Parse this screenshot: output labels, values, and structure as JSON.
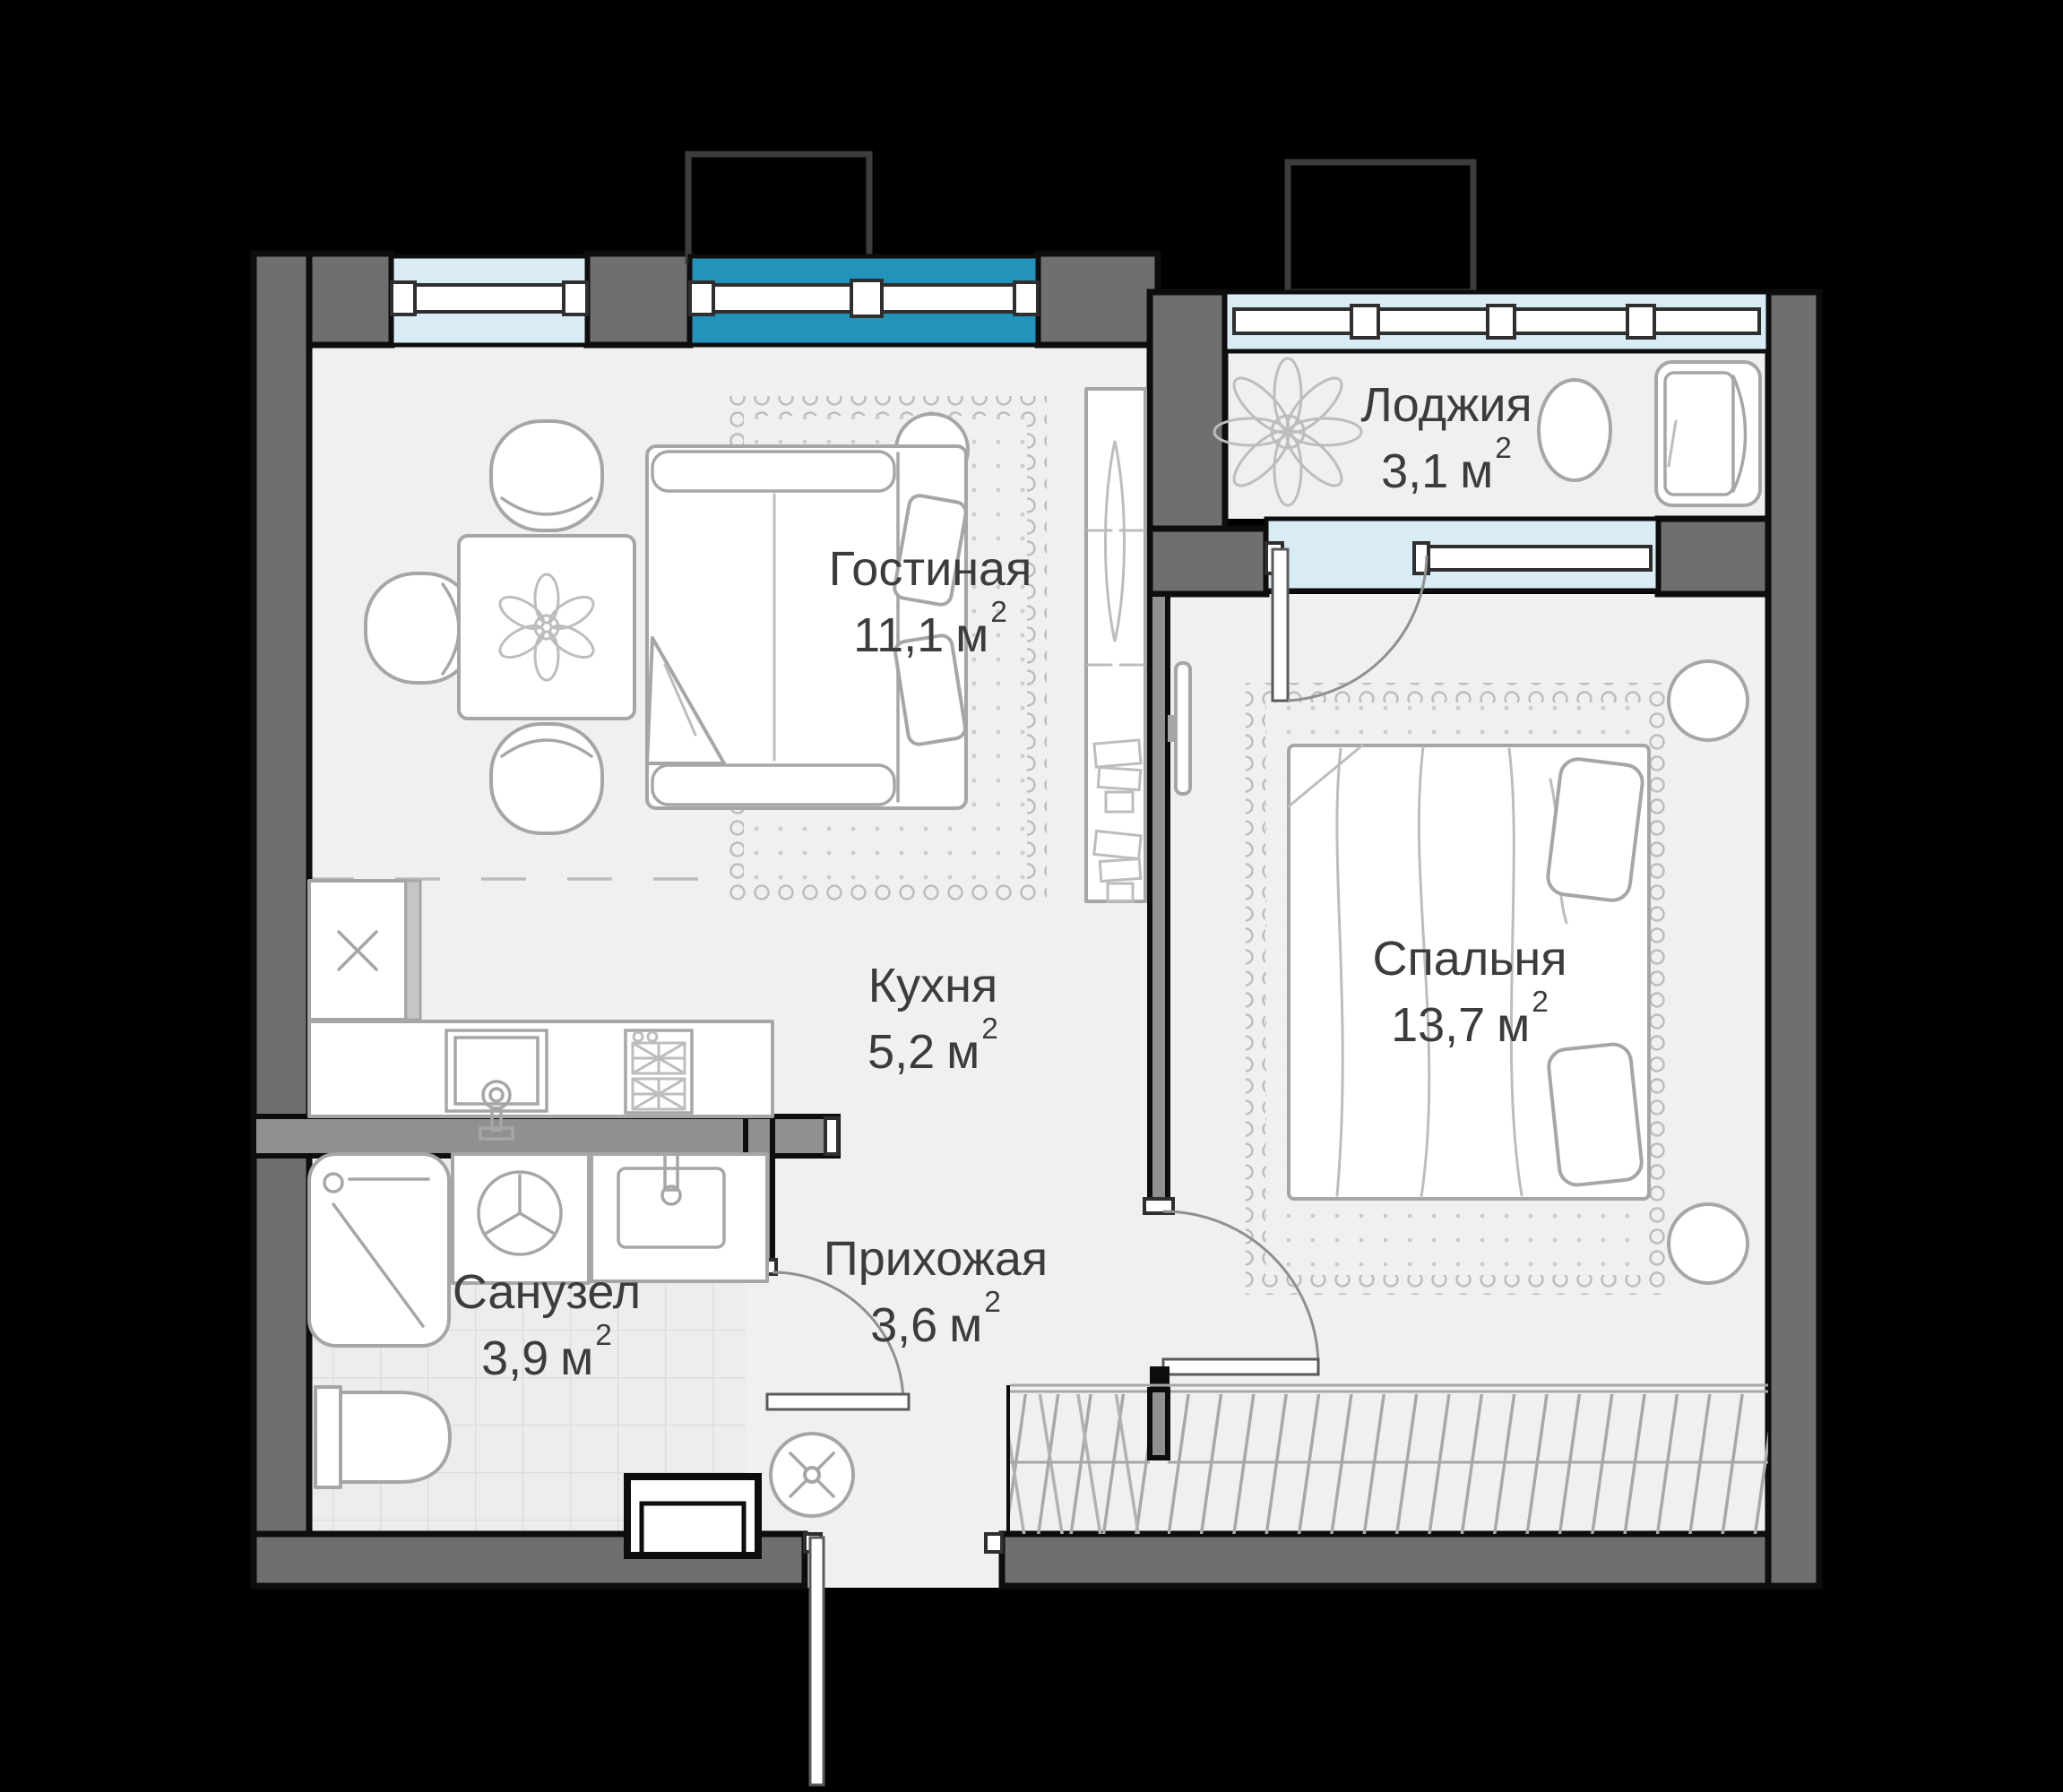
{
  "plan_title": "",
  "rooms": [
    {
      "id": "living-room",
      "name": "Гостиная",
      "area": "11,1",
      "unit": "м",
      "sup": "2"
    },
    {
      "id": "loggia",
      "name": "Лоджия",
      "area": "3,1",
      "unit": "м",
      "sup": "2"
    },
    {
      "id": "kitchen",
      "name": "Кухня",
      "area": "5,2",
      "unit": "м",
      "sup": "2"
    },
    {
      "id": "bedroom",
      "name": "Спальня",
      "area": "13,7",
      "unit": "м",
      "sup": "2"
    },
    {
      "id": "bathroom",
      "name": "Санузел",
      "area": "3,9",
      "unit": "м",
      "sup": "2"
    },
    {
      "id": "hallway",
      "name": "Прихожая",
      "area": "3,6",
      "unit": "м",
      "sup": "2"
    }
  ],
  "colors": {
    "bg": "#000000",
    "wall": "#6f6f6f",
    "wall-light": "#909090",
    "outline": "#0d0d0d",
    "floor": "#f0f0f1",
    "win-blue": "#d9ecf6",
    "win-teal": "#2293bb",
    "furn": "#a6a6a6",
    "furn-l": "#bdbdbd",
    "text": "#3c3c3c"
  }
}
